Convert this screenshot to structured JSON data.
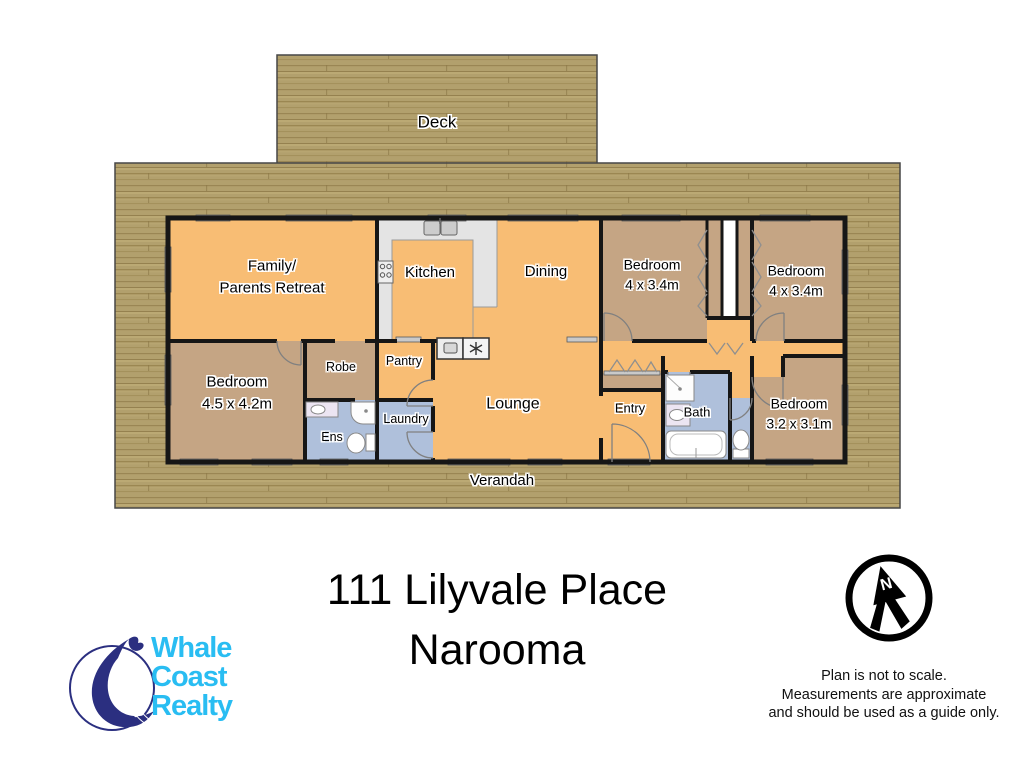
{
  "address": {
    "line1": "111 Lilyvale Place",
    "line2": "Narooma"
  },
  "agency": {
    "name_line1": "Whale",
    "name_line2": "Coast",
    "name_line3": "Realty",
    "text_color": "#29bdf2",
    "whale_color": "#2b2f80"
  },
  "compass": {
    "north_label": "N"
  },
  "disclaimer": {
    "line1": "Plan is not to scale.",
    "line2": "Measurements are approximate",
    "line3": "and should be used as a guide only."
  },
  "rooms": {
    "deck": {
      "label": "Deck"
    },
    "verandah": {
      "label": "Verandah"
    },
    "family": {
      "label": "Family/",
      "label2": "Parents Retreat"
    },
    "kitchen": {
      "label": "Kitchen"
    },
    "dining": {
      "label": "Dining"
    },
    "lounge": {
      "label": "Lounge"
    },
    "entry": {
      "label": "Entry"
    },
    "bath": {
      "label": "Bath"
    },
    "ens": {
      "label": "Ens"
    },
    "robe": {
      "label": "Robe"
    },
    "pantry": {
      "label": "Pantry"
    },
    "laundry": {
      "label": "Laundry"
    },
    "bedroom_top_1": {
      "label": "Bedroom",
      "size": "4 x 3.4m"
    },
    "bedroom_top_2": {
      "label": "Bedroom",
      "size": "4 x 3.4m"
    },
    "bedroom_left": {
      "label": "Bedroom",
      "size": "4.5 x 4.2m"
    },
    "bedroom_right": {
      "label": "Bedroom",
      "size": "3.2 x 3.1m"
    }
  },
  "colors": {
    "wood": "#b2a06d",
    "living_area": "#f8bd74",
    "bedroom": "#c5a584",
    "wet_area": "#afc0db",
    "counter": "#e4e4e4",
    "wall": "#161616"
  }
}
